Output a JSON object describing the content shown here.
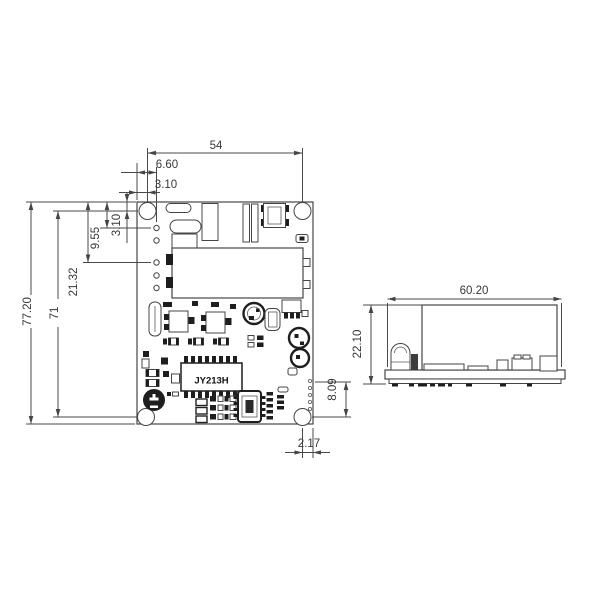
{
  "colors": {
    "background": "#ffffff",
    "line": "#4a4a4a",
    "text": "#383838",
    "component_fill_dark": "#1e1e1e"
  },
  "top_view": {
    "ic_label": "JY213H",
    "dims": {
      "mount_hole_pitch_x": "54",
      "pin_column_offset": "6.60",
      "hole_offset_x": "3.10",
      "hole_offset_y": "3.10",
      "pin_row_offset_1": "9.55",
      "pin_row_offset_2": "21.32",
      "mount_hole_pitch_y": "71",
      "board_height": "77.20",
      "pin_strip_length": "8.09",
      "hole_offset_right": "2.17"
    }
  },
  "side_view": {
    "dims": {
      "board_length": "60.20",
      "overall_height": "22.10"
    }
  }
}
